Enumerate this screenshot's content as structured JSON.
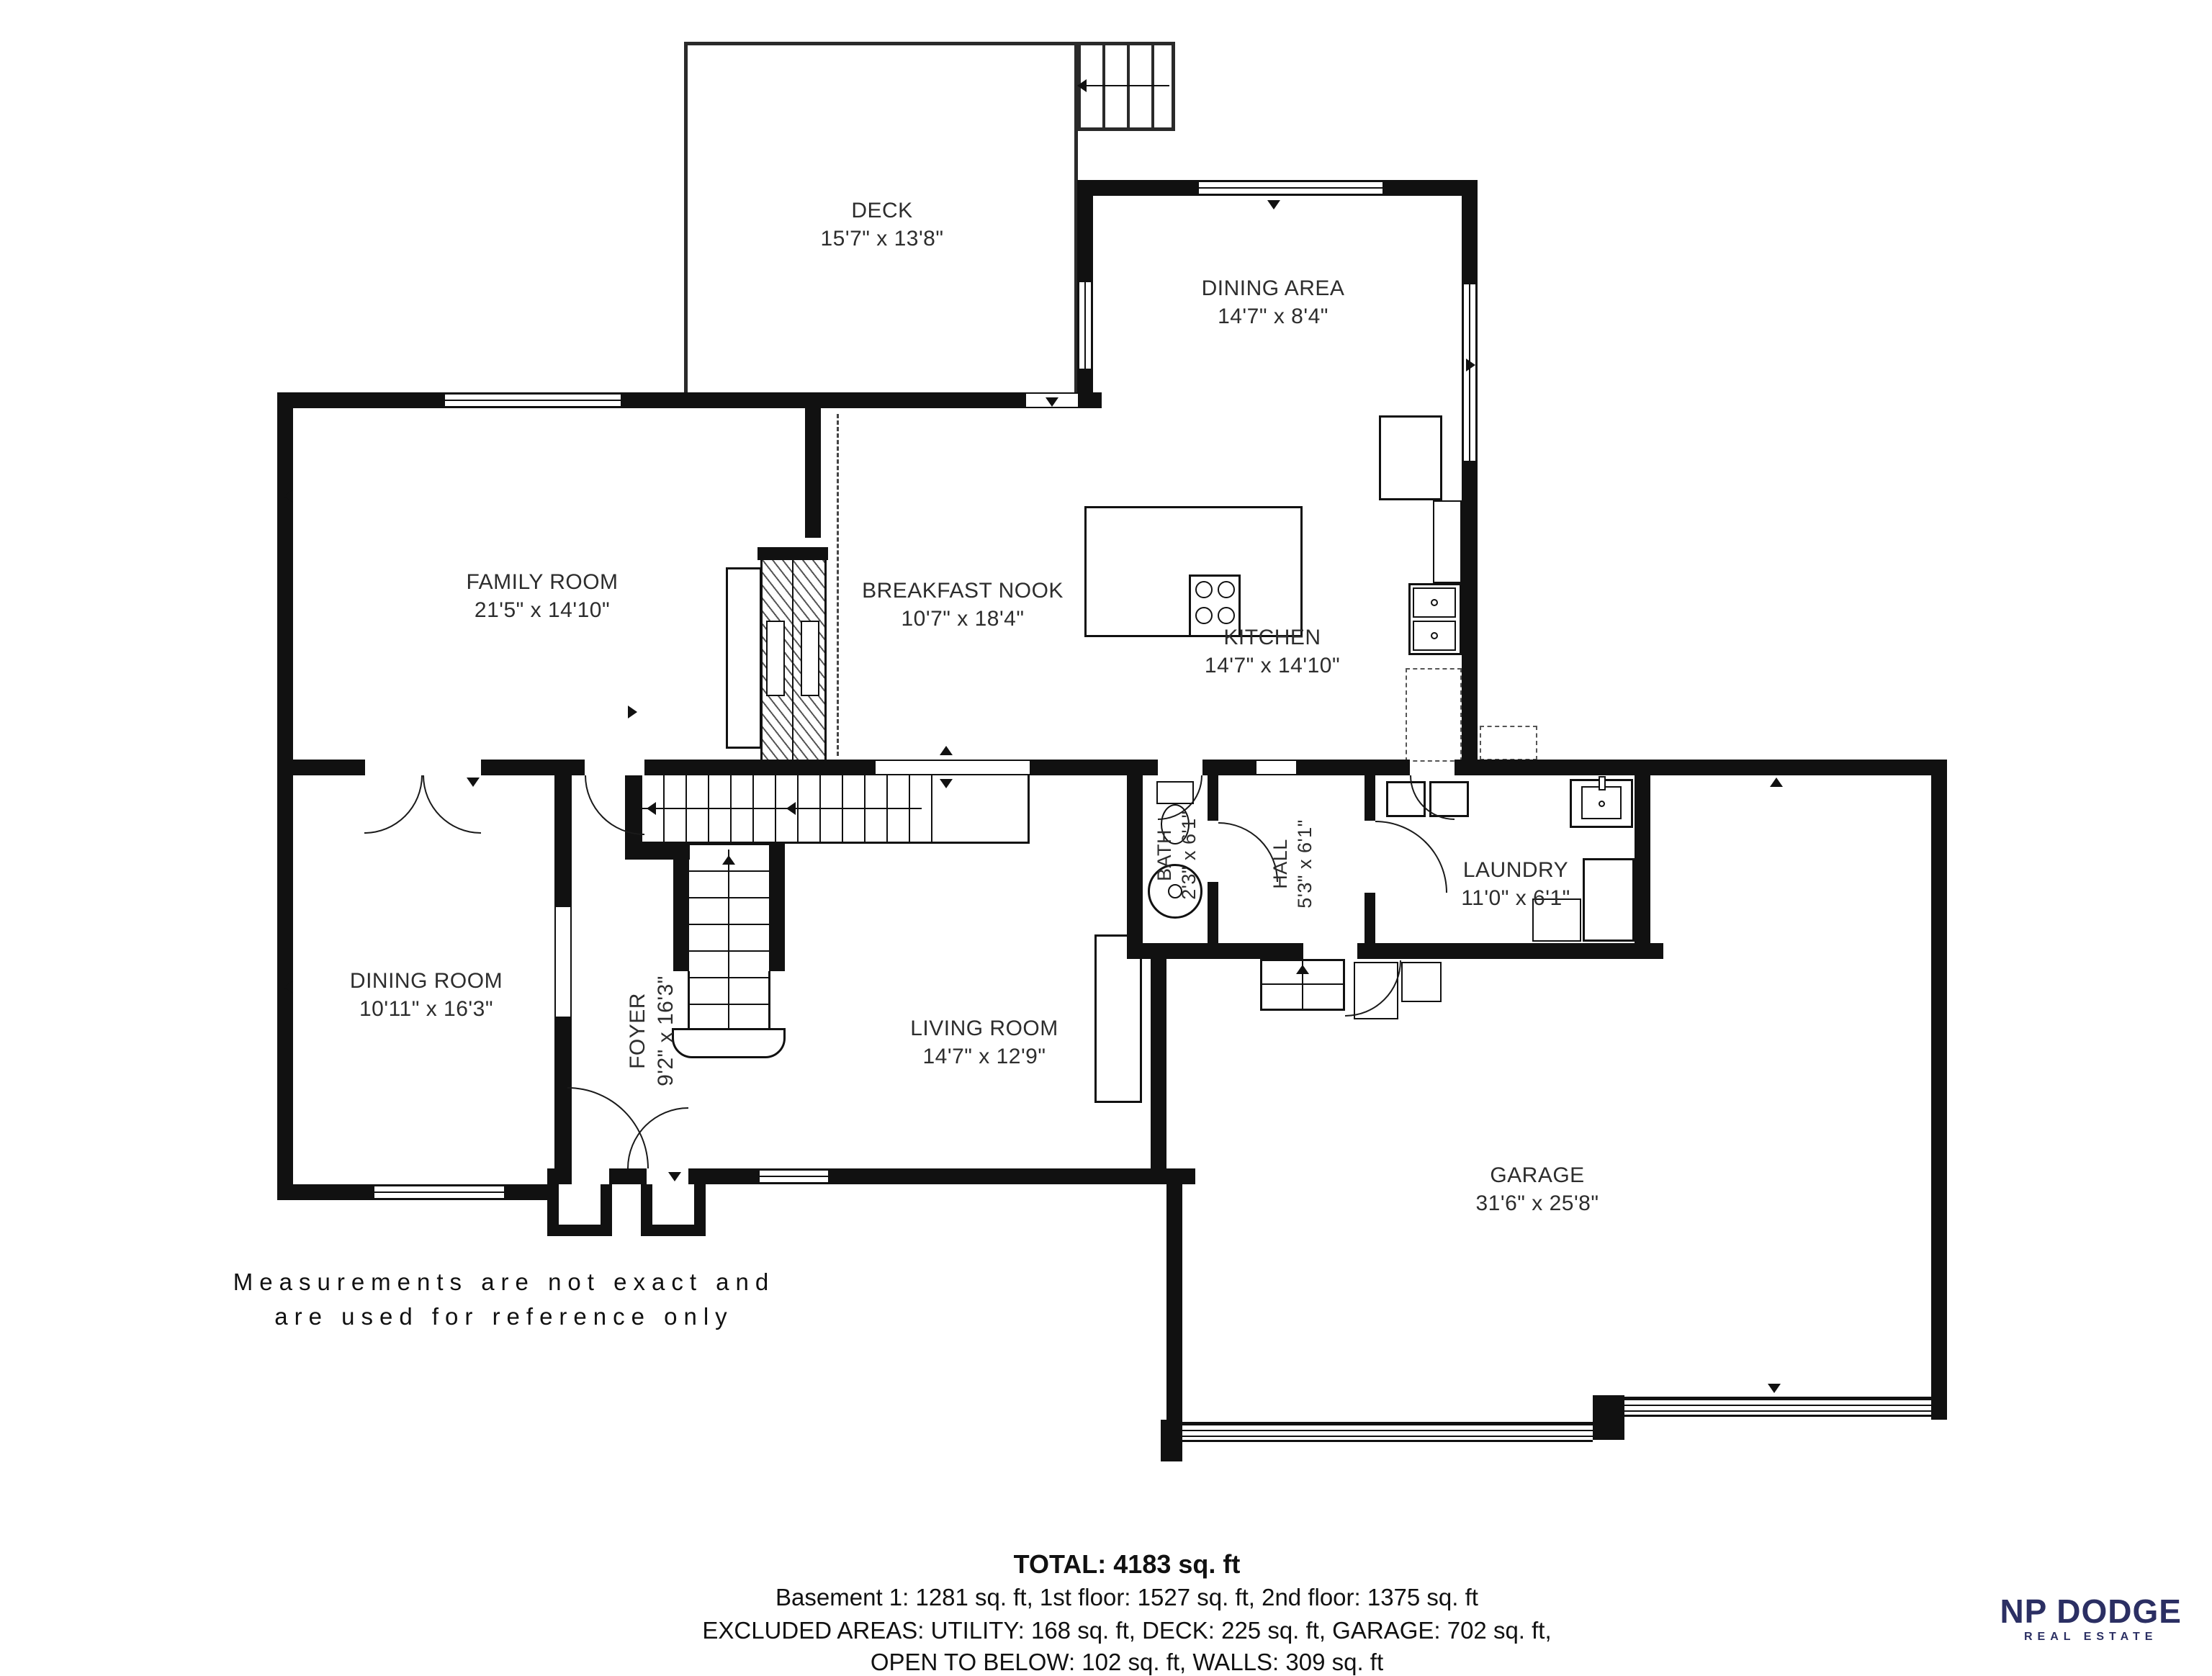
{
  "note": {
    "line1": "Measurements are not exact and",
    "line2": "are used for reference only"
  },
  "rooms": {
    "deck": {
      "name": "DECK",
      "dims": "15'7\" x 13'8\""
    },
    "dining_area": {
      "name": "DINING AREA",
      "dims": "14'7\" x 8'4\""
    },
    "family_room": {
      "name": "FAMILY ROOM",
      "dims": "21'5\" x 14'10\""
    },
    "breakfast_nook": {
      "name": "BREAKFAST NOOK",
      "dims": "10'7\" x 18'4\""
    },
    "kitchen": {
      "name": "KITCHEN",
      "dims": "14'7\" x 14'10\""
    },
    "dining_room": {
      "name": "DINING ROOM",
      "dims": "10'11\" x 16'3\""
    },
    "foyer": {
      "name": "FOYER",
      "dims": "9'2\" x 16'3\""
    },
    "living_room": {
      "name": "LIVING ROOM",
      "dims": "14'7\" x 12'9\""
    },
    "bath": {
      "name": "BATH",
      "dims": "2'3\" x 6'1\""
    },
    "hall": {
      "name": "HALL",
      "dims": "5'3\" x 6'1\""
    },
    "laundry": {
      "name": "LAUNDRY",
      "dims": "11'0\" x 6'1\""
    },
    "garage": {
      "name": "GARAGE",
      "dims": "31'6\" x 25'8\""
    }
  },
  "summary": {
    "total": "TOTAL: 4183 sq. ft",
    "floors": "Basement 1: 1281 sq. ft, 1st floor: 1527 sq. ft, 2nd floor: 1375 sq. ft",
    "excluded1": "EXCLUDED AREAS: UTILITY: 168 sq. ft, DECK: 225 sq. ft, GARAGE: 702 sq. ft,",
    "excluded2": "OPEN TO BELOW: 102 sq. ft, WALLS: 309 sq. ft"
  },
  "brand": {
    "name": "NP DODGE",
    "tagline": "REAL ESTATE",
    "color": "#2b2f63"
  }
}
